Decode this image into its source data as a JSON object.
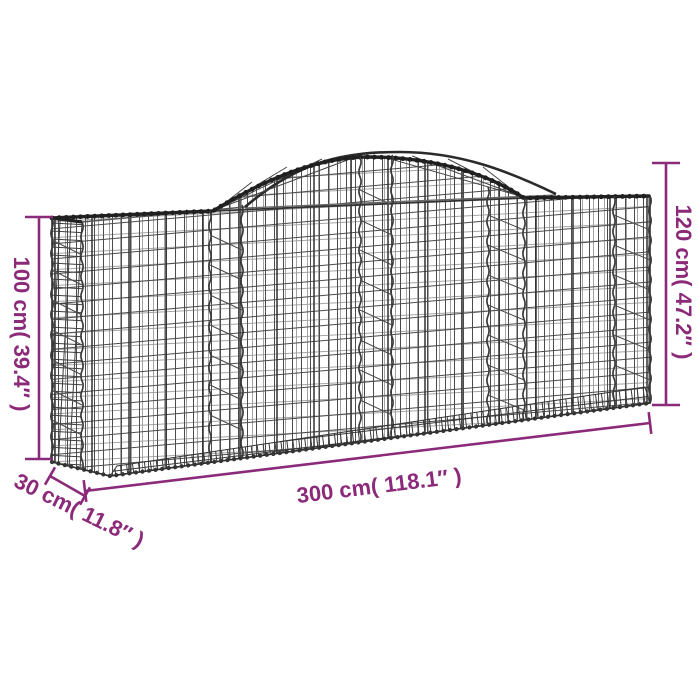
{
  "illustration": {
    "subject": "arched gabion wire mesh basket",
    "view": "three-quarter perspective line drawing"
  },
  "annotations": {
    "height_left": {
      "text": "100 cm( 39.4″ )",
      "cm": "100",
      "inches": "39.4"
    },
    "height_right": {
      "text": "120 cm( 47.2″ )",
      "cm": "120",
      "inches": "47.2"
    },
    "length": {
      "text": "300 cm( 118.1″ )",
      "cm": "300",
      "inches": "118.1"
    },
    "depth": {
      "text": "30 cm( 11.8″ )",
      "cm": "30",
      "inches": "11.8"
    }
  },
  "colors": {
    "dimension_accent": "#8C2A7A",
    "wire_dark": "#2b2b2b",
    "wire_mid": "#4b4b4b",
    "wire_light": "#9a9a9a",
    "background": "#ffffff"
  }
}
